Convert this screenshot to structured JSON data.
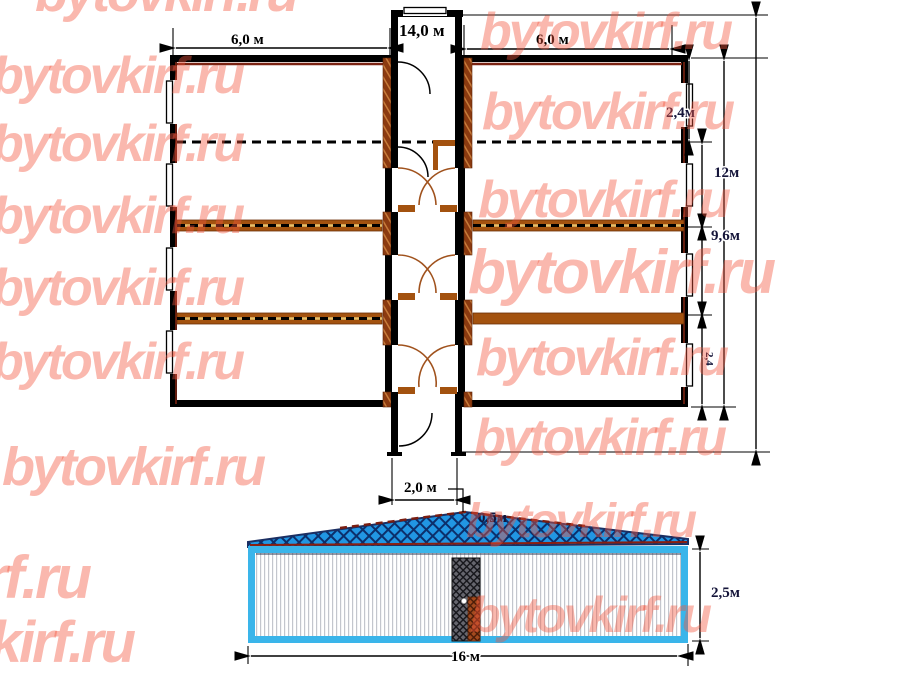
{
  "watermark": {
    "text": "bytovkirf.ru",
    "color": "#f8a89b"
  },
  "plan_dimensions": {
    "left_wing_width": "6,0 м",
    "corridor_length": "14,0 м",
    "right_wing_width": "6,0 м",
    "first_room_depth": "2,4м",
    "building_depth": "12м",
    "rooms_span": "9,6м",
    "room_depth_side": "2,4",
    "corridor_width": "2,0 м"
  },
  "elevation_dimensions": {
    "roof_rise": "0,5м",
    "wall_height": "2,5м",
    "length": "16 м"
  },
  "colors": {
    "watermark_pink": "#f8a89b",
    "partition_brown": "#a3520f",
    "wall_black": "#000000",
    "roof_blue": "#2196e3",
    "frame_cyan": "#3ab5ea",
    "lining_dark_red": "#7b2312"
  }
}
